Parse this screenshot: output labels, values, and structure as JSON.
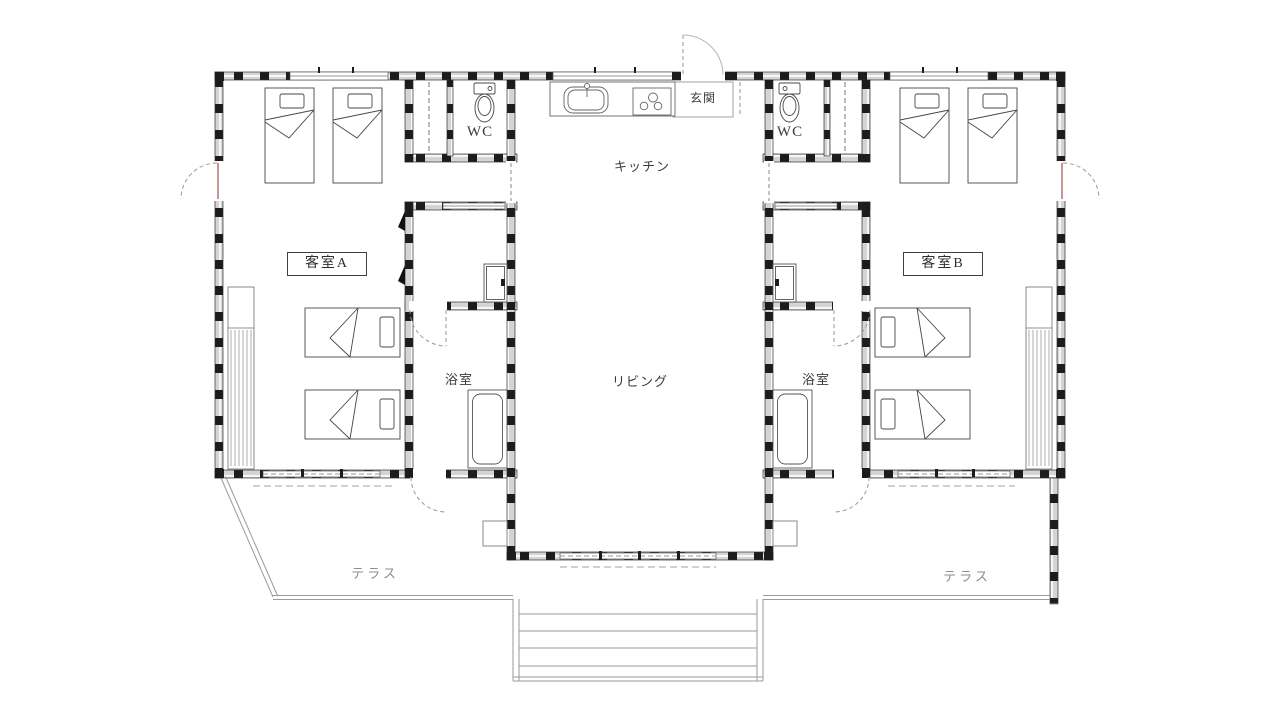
{
  "plan": {
    "rooms": {
      "guest_room_a": "客室A",
      "guest_room_b": "客室B",
      "kitchen": "キッチン",
      "living": "リビング",
      "bath_left": "浴室",
      "bath_right": "浴室",
      "wc_left": "WC",
      "wc_right": "WC",
      "entrance": "玄関",
      "terrace_left": "テラス",
      "terrace_right": "テラス"
    },
    "colors": {
      "wall_fill": "#d4d4d4",
      "post": "#1c1c1c",
      "outline": "#2f2f2f",
      "fixture_line": "#4a4a4a",
      "light_line": "#9a9a9a",
      "label_text": "#3b3b3b",
      "terrace_text": "#8d8d8d",
      "door_leaf": "#b06a62"
    }
  }
}
